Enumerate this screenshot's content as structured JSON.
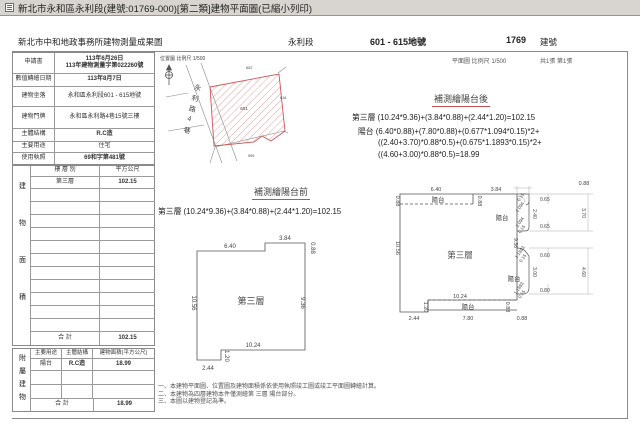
{
  "window": {
    "title": "新北市永和區永利段(建號:01769-000)[第二類]建物平面圖(已縮小列印)"
  },
  "header": {
    "office": "新北市中和地政事務所建物測量成果圖",
    "section": "永利段",
    "lots": "601 - 615地號",
    "building_no": "1769",
    "building_no_label": "建號"
  },
  "info": {
    "rows": [
      {
        "label": "申請書",
        "value": "113年6月26日\n113年建物測量字第022260號"
      },
      {
        "label": "數值轉繪日期",
        "value": "113年8月7日"
      },
      {
        "label": "建物坐落",
        "value": "永和區永利段601 - 615地號"
      },
      {
        "label": "建物門牌",
        "value": "永和區永利路4巷15號三樓"
      },
      {
        "label": "主體結構",
        "value": "R.C造"
      },
      {
        "label": "主要用途",
        "value": "住宅"
      },
      {
        "label": "使用執照",
        "value": "69和字第481號"
      }
    ]
  },
  "area_table": {
    "side_label": "建物面積",
    "col_floor": "樓 層 別",
    "col_area": "平方公尺",
    "row_floor": "第三層",
    "row_area": "102.15",
    "total_label": "合  計",
    "total": "102.15"
  },
  "accessory_table": {
    "side_label": "附屬建物",
    "col_use": "主要用途",
    "col_structure": "主體結構",
    "col_area": "建物面積(平方公尺)",
    "row_use": "陽台",
    "row_structure": "R.C造",
    "row_area": "18.99",
    "total_label": "合  計",
    "total": "18.99"
  },
  "location_map": {
    "caption": "位置圖 比例尺 1/500",
    "street": "永利路4巷",
    "parcel_no": "601",
    "neighbor_top": "602",
    "neighbor_right": "616",
    "neighbor_bottom": "599"
  },
  "plan_sheet": {
    "caption": "平面圖 比例尺 1/500",
    "pages": "共1張 第1張"
  },
  "after_block": {
    "title": "補測繪陽台後",
    "line1": "第三層 (10.24*9.36)+(3.84*0.88)+(2.44*1.20)=102.15",
    "line2": "陽台 (6.40*0.88)+(7.80*0.88)+(0.677*1.094*0.15)*2+",
    "line3": "((2.40+3.70)*0.88*0.5)+(0.675*1.1893*0.15)*2+",
    "line4": "((4.60+3.00)*0.88*0.5)=18.99"
  },
  "before_block": {
    "title": "補測繪陽台前",
    "line1": "第三層 (10.24*9.36)+(3.84*0.88)+(2.44*1.20)=102.15"
  },
  "plan_before": {
    "label": "第三層",
    "top_left": "6.40",
    "top_right": "3.84",
    "right_step": "0.88",
    "left": "10.56",
    "right": "9.36",
    "bottom": "10.24",
    "notch_h": "1.20",
    "notch_w": "2.44"
  },
  "plan_after": {
    "label": "第三層",
    "balcony_top": "陽台",
    "balcony_right_up": "陽台",
    "balcony_right_low": "陽台",
    "balcony_bottom": "陽台",
    "top_left": "6.40",
    "top_right": "3.84",
    "top_depth": "0.88",
    "strip_left": "0.88",
    "strip_mid": "0.88",
    "left": "10.56",
    "right": "9.36",
    "up_c1": "0.15",
    "up_d1": "1.094",
    "up_w1": "0.65",
    "up_in": "2.40",
    "up_out": "3.70",
    "up_d2": "1.094",
    "up_c2": "0.15",
    "up_w2": "0.65",
    "low_d1": "1.1893",
    "low_c1": "0.15",
    "low_w1": "0.60",
    "low_in": "3.00",
    "low_out": "4.60",
    "low_d2": "1.1893",
    "low_c2": "0.15",
    "low_w2": "0.80",
    "bottom_in": "10.24",
    "bottom_strip": "7.80",
    "strip_h_l": "0.88",
    "strip_h_r": "0.88",
    "notch_h": "1.20",
    "notch_w": "2.44"
  },
  "notes": {
    "n1": "一、本建物平面圖、位置圖及建物面積係依使用執照竣工圖或竣工平面圖轉繪計算。",
    "n2": "二、本建物為四層建物本件僅測繪第 三層 陽台部分。",
    "n3": "三、本圖以建物登記為準。"
  }
}
